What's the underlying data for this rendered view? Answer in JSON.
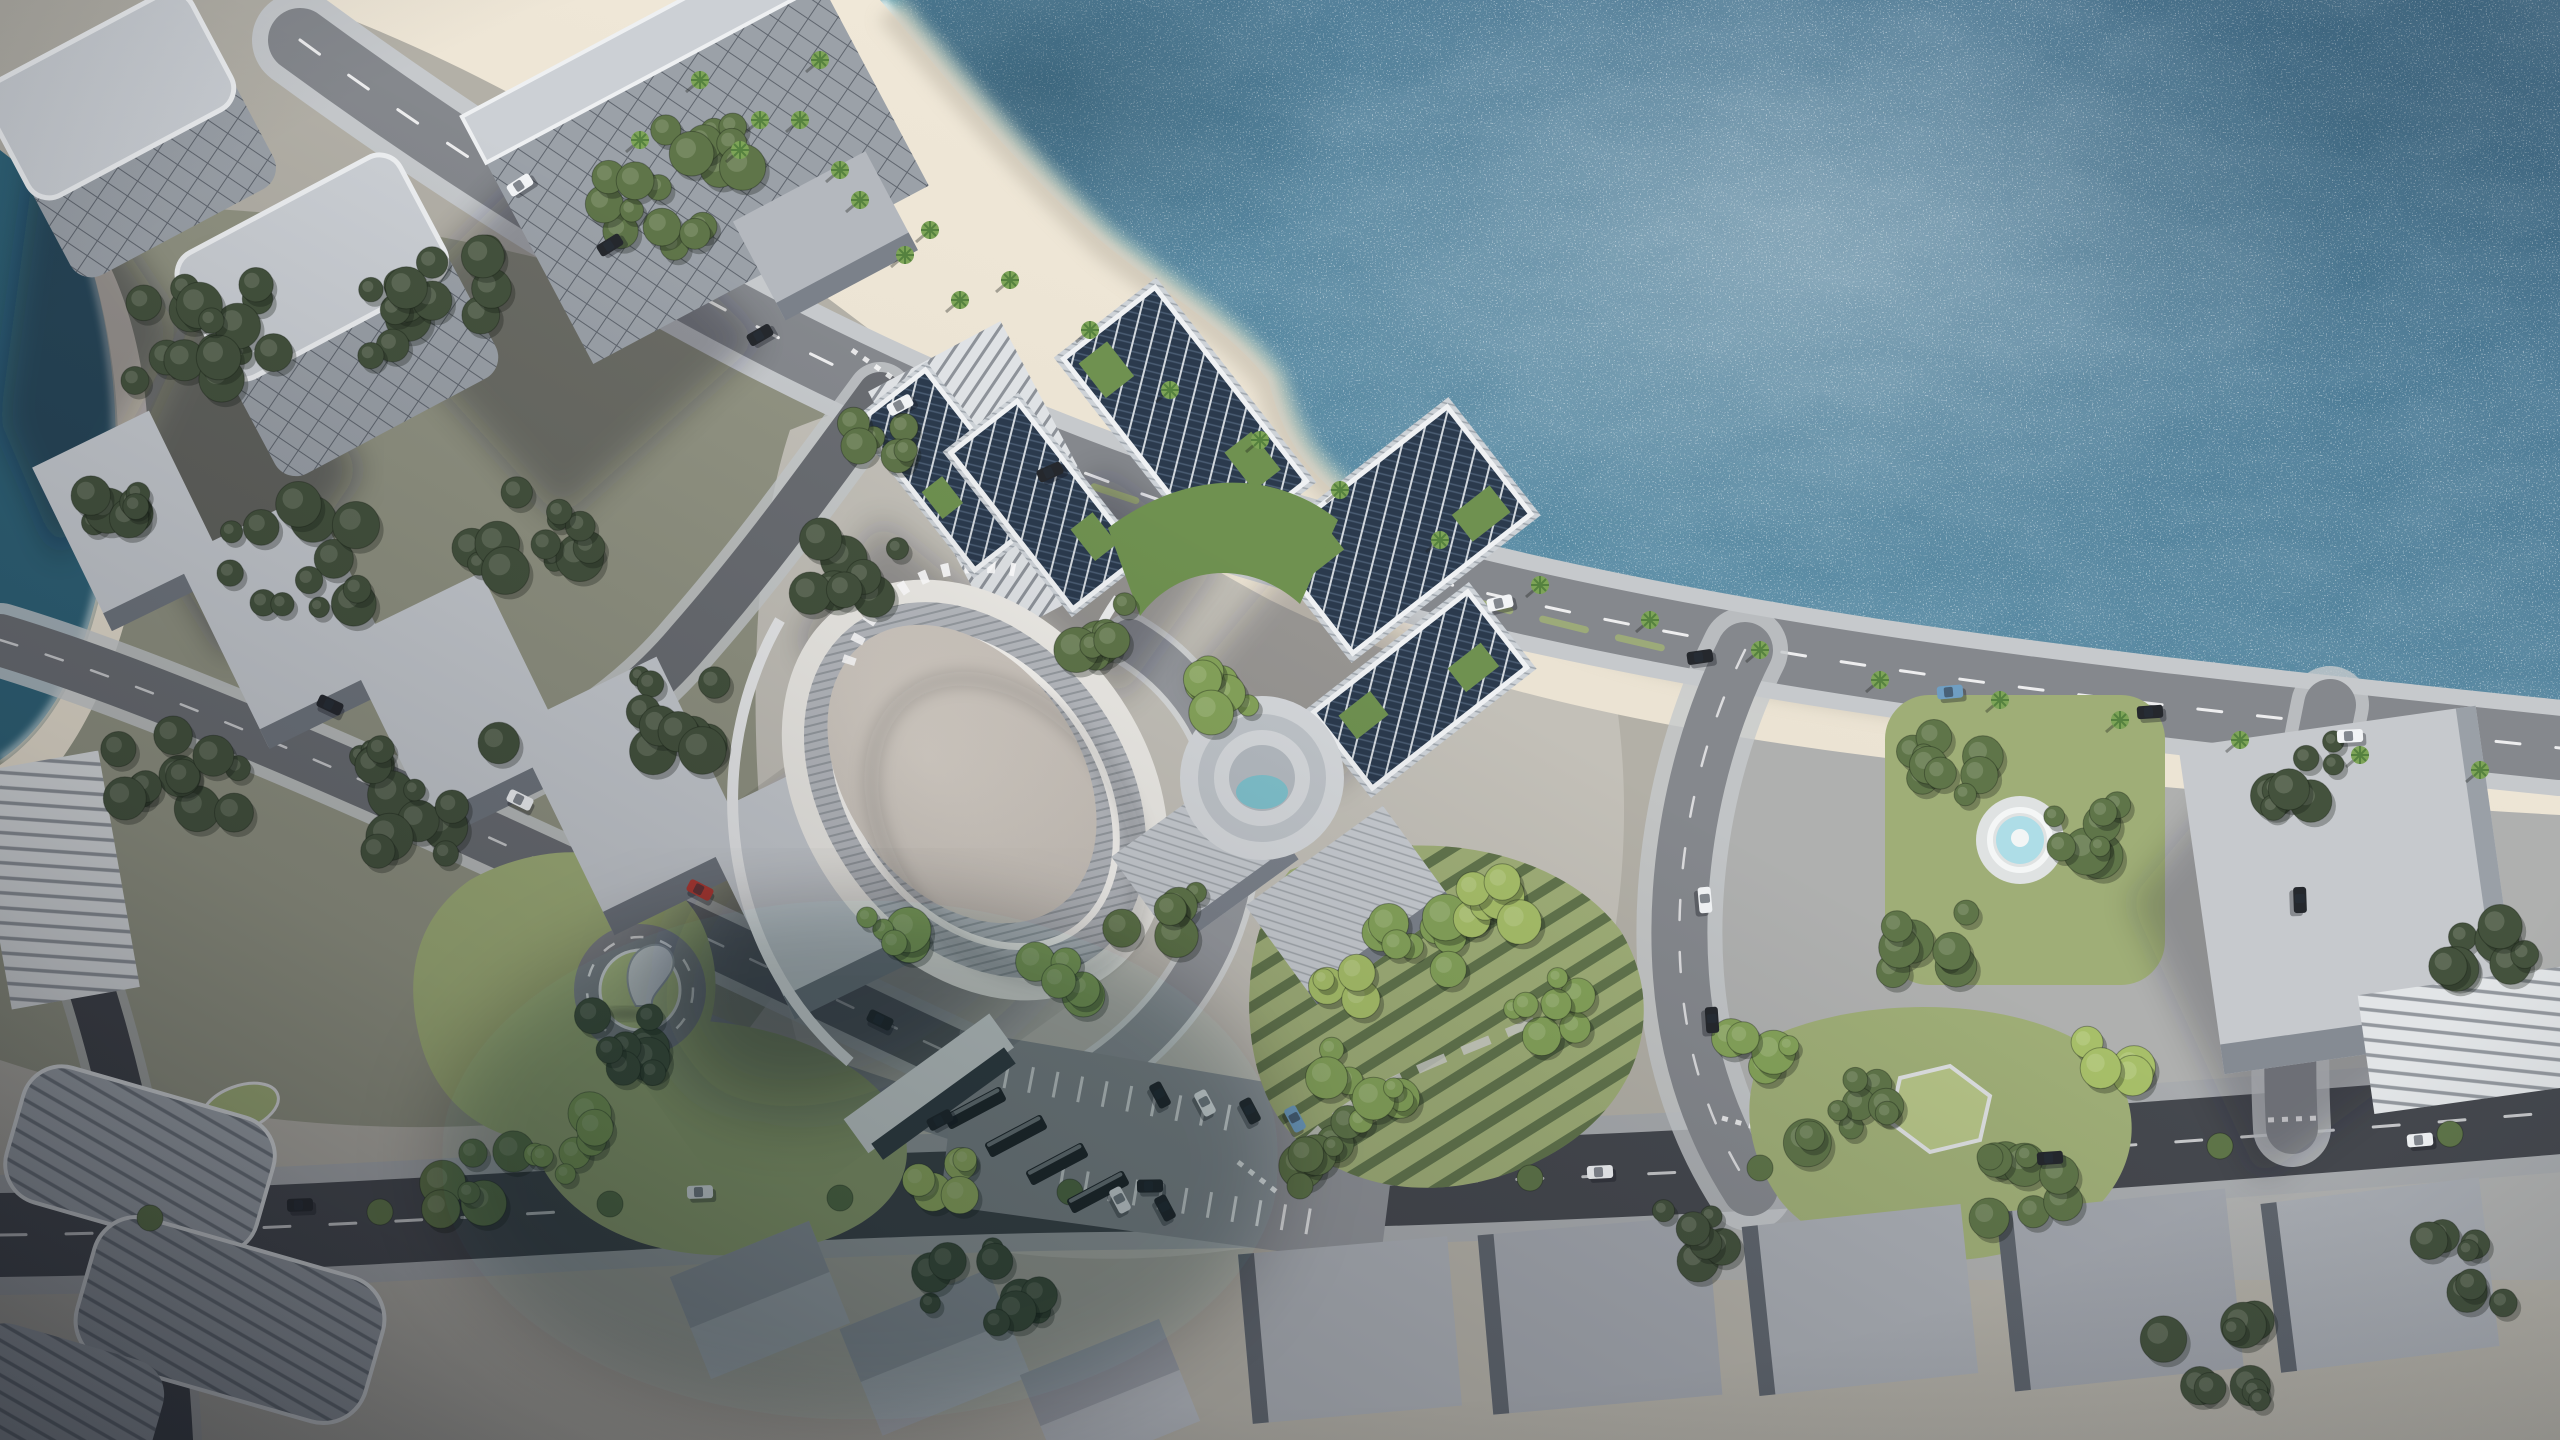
{
  "palette": {
    "ground": "#b3b0a7",
    "park_ground": "#7a8069",
    "campus_ground": "#c3c0b8",
    "district_ground": "#aeb1b3",
    "sea_deep": "#44708c",
    "sea_mid": "#578aa3",
    "sea_shallow": "#5ec1cb",
    "sea_teal_corner": "#2e6277",
    "foam": "#f4fbfa",
    "shallow_band": "#8fd9da",
    "sand": "#e7dfcf",
    "sand_bright": "#f3ebdb",
    "sand_wet": "#ccc5b5",
    "road": "#85888d",
    "road_mid": "#6a6d72",
    "road_dark": "#45484e",
    "road_darker": "#3f4248",
    "sidewalk": "#c6c9cc",
    "sidewalk_dim": "#a8abae",
    "lane_mark": "#ffffff",
    "roof_light": "#ccd0d5",
    "wall_lit": "#dfe2e5",
    "wall_mid": "#9ba1a8",
    "wall_dark": "#646b74",
    "warehouse_roof": "#c7cbd0",
    "warehouse_side": "#70767e",
    "dome_shell": "#edebe6",
    "dome_band": "#b7babf",
    "dome_top": "#d9d2c9",
    "dome_rim": "#f6f4f0",
    "solar": "#2b3a4d",
    "solar_frame": "#eff1f3",
    "louver": "#cdd2d7",
    "greenroof": "#6f9150",
    "tree_dark": "#44523d",
    "tree_mid": "#5f7549",
    "tree_light": "#85a35a",
    "tree_bright": "#a7bf69",
    "palm": "#7da457",
    "palm_dark": "#55813f",
    "lawn": "#9fae77",
    "lawn_bright": "#b4c286",
    "hedge": "#4d6a40",
    "pool": "#7fc0cb",
    "fountain_water": "#aedde7",
    "car_white": "#f2f4f6",
    "car_dark": "#25282d",
    "car_red": "#b23a33",
    "car_blue": "#6f9ec2",
    "bus_dark": "#23262b",
    "shadow": "rgba(22,26,34,0.40)",
    "shadow_soft": "rgba(18,22,30,0.30)"
  }
}
